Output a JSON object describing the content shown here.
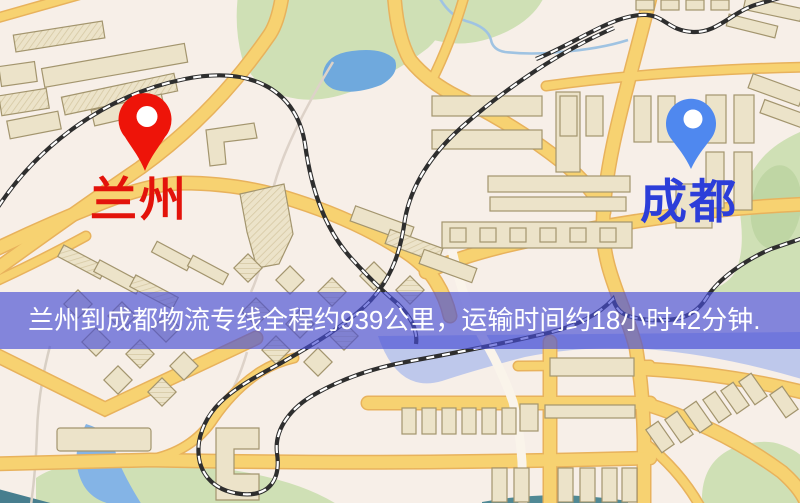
{
  "banner": {
    "text": "兰州到成都物流专线全程约939公里，运输时间约18小时42分钟.",
    "background_color": "#484ed4",
    "text_color": "#ffffff"
  },
  "route": {
    "origin": "兰州",
    "destination": "成都",
    "service": "物流专线",
    "distance_text": "全程约939公里",
    "distance_km": 939,
    "duration_text": "运输时间约18小时42分钟",
    "duration_hours": 18,
    "duration_minutes": 42
  },
  "map": {
    "origin_marker": {
      "label": "兰州",
      "pin_color": "#ee1409",
      "label_color": "#e3130b",
      "icon": "map-pin-icon"
    },
    "destination_marker": {
      "label": "成都",
      "pin_color": "#4f88ef",
      "label_color": "#2c3ed9",
      "icon": "map-pin-icon"
    },
    "palette": {
      "background": "#f7efe8",
      "road_fill": "#f7d271",
      "road_casing": "#e8b25c",
      "railway": "#2e2e2e",
      "park_green": "#cfe0b5",
      "water_blue": "#7fb2e2",
      "building_beige": "#ece3c9"
    }
  }
}
